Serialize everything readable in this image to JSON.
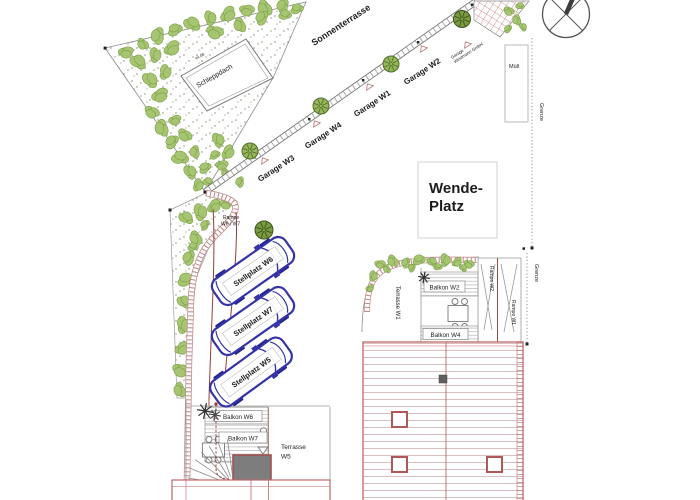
{
  "plan": {
    "labels": {
      "sonnenterrasse": "Sonnenterrasse",
      "schleppdach": "Schleppdach",
      "roof_dimension": "44.08",
      "garage_w3": "Garage W3",
      "garage_w4": "Garage W4",
      "garage_w1": "Garage W1",
      "garage_w2": "Garage W2",
      "garage_note_line1": "Garage",
      "garage_note_line2": "Weidmann GmbH",
      "muell": "Müll",
      "grenze_top": "Grenze",
      "grenze_right": "Grenze",
      "wendeplatz_line1": "Wende-",
      "wendeplatz_line2": "Platz",
      "rampe_w6_w7_line1": "Rampe",
      "rampe_w6_w7_line2": "W6 / W7",
      "stellplatz_w6": "Stellplatz W6",
      "stellplatz_w7": "Stellplatz W7",
      "stellplatz_w5": "Stellplatz W5",
      "balkon_w6": "Balkon W6",
      "balkon_w7": "Balkon W7",
      "terrasse_w5_line1": "Terrasse",
      "terrasse_w5_line2": "W5",
      "terrasse_w1": "Terrasse W1",
      "balkon_w2": "Balkon W2",
      "balkon_w4": "Balkon W4",
      "rampe_w2": "Rampe W2",
      "rampe_w1": "Rampe W1"
    },
    "colors": {
      "vegetation": "#a5c571",
      "building_line": "#c06868",
      "wall_hatch": "#c08585",
      "car_blue": "#3434a8",
      "boundary_gray": "#909090",
      "dark_block": "#7d7d7d"
    }
  }
}
